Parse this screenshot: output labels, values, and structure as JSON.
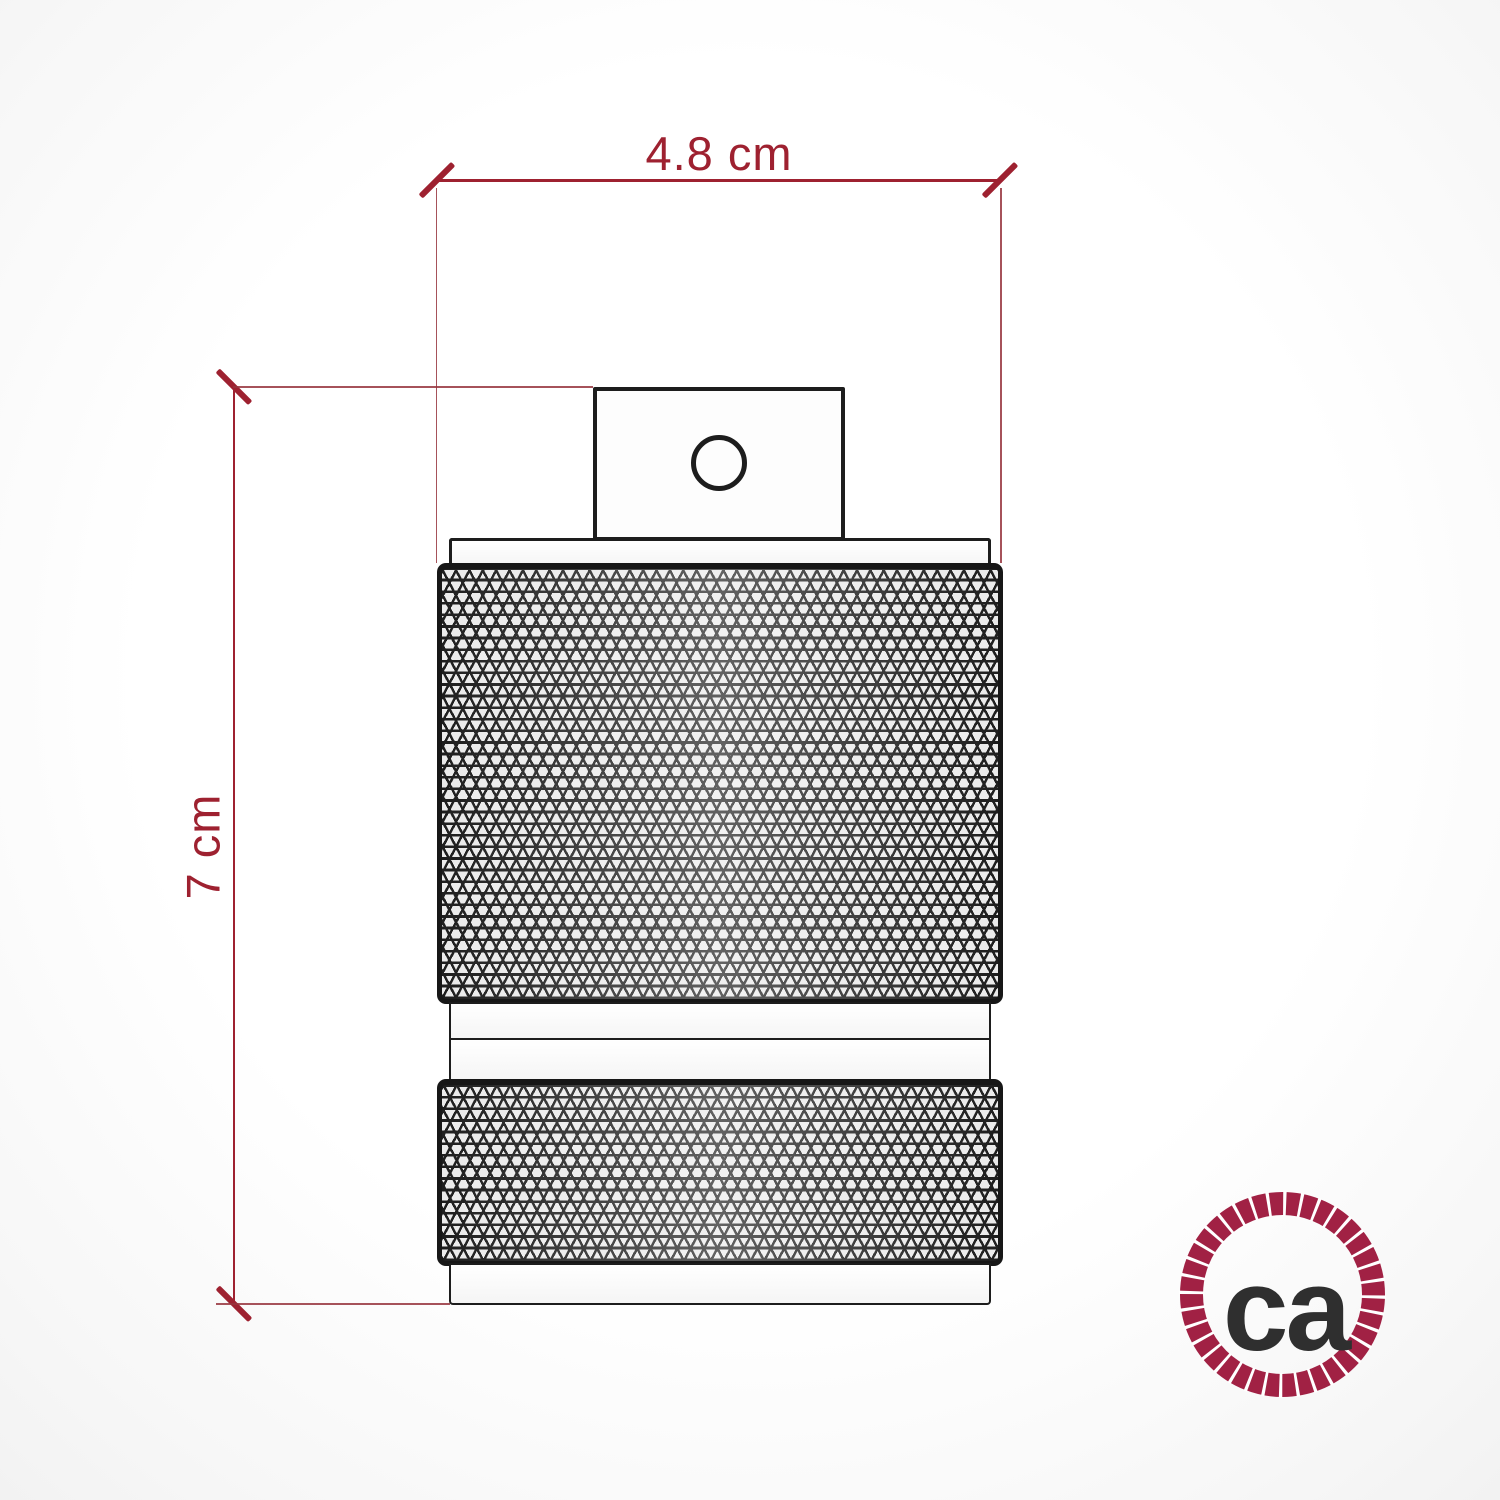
{
  "dimensions": {
    "width": {
      "label": "4.8 cm"
    },
    "height": {
      "label": "7 cm"
    },
    "color": "#9e2130"
  },
  "object": {
    "outline_color": "#1d1d1d",
    "parts": {
      "cable_entry_block": "cable-entry-block",
      "cable_hole": "cable-hole",
      "top_flange": "top-flange",
      "upper_knurled_section": "upper-knurled-section",
      "smooth_ring_upper": "smooth-ring-upper",
      "smooth_ring_lower": "smooth-ring-lower",
      "lower_knurled_section": "lower-knurled-section",
      "bottom_cap": "bottom-cap"
    }
  },
  "logo": {
    "text": "ca",
    "ring_color": "#a12144",
    "text_color": "#2f2f2f"
  }
}
